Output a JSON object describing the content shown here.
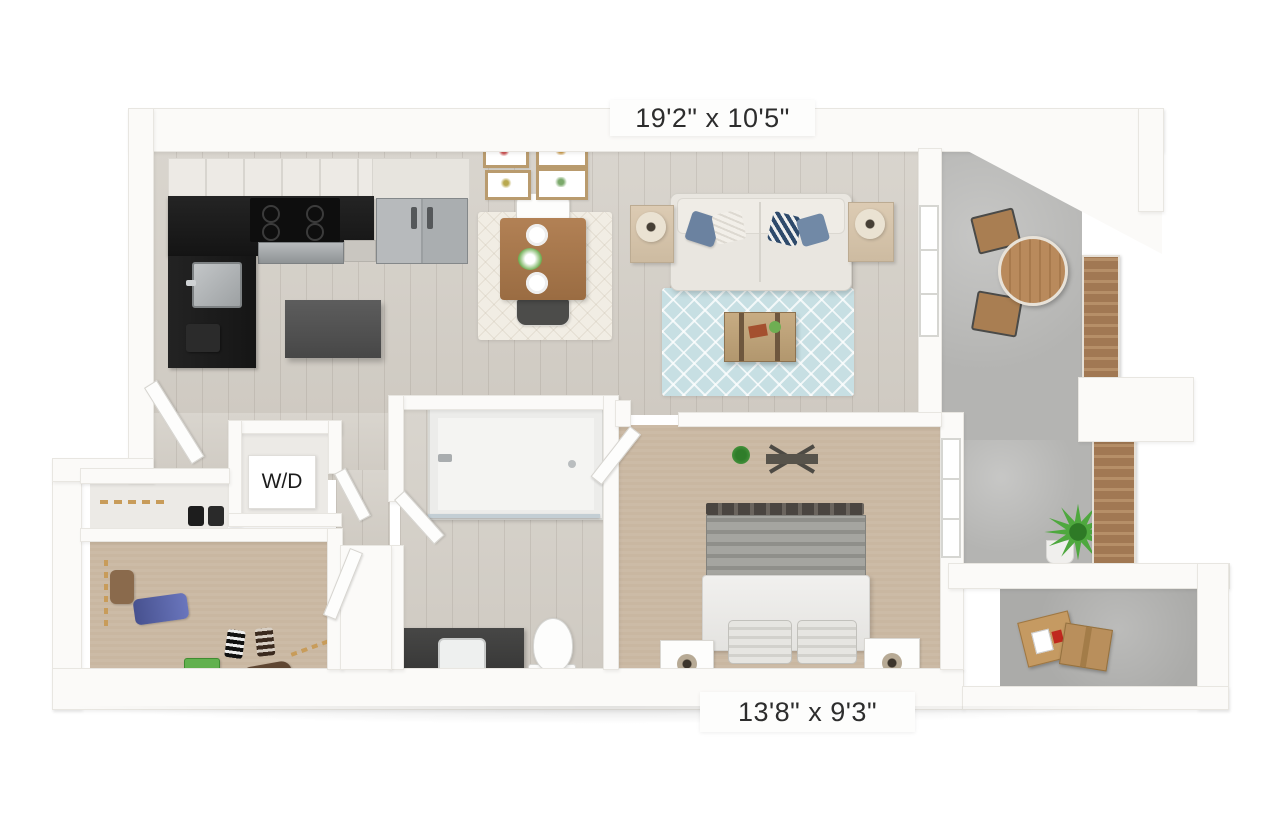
{
  "labels": {
    "living_room_dimensions": "19'2\" x 10'5\"",
    "bedroom_dimensions": "13'8\" x 9'3\"",
    "washer_dryer": "W/D"
  },
  "colors": {
    "background": "#ffffff",
    "wall": "#fbfaf8",
    "wood_floor": "#d5d1c9",
    "carpet_tan": "#c9b7a1",
    "concrete_gray": "#b4b4b2",
    "counter_black": "#191919",
    "island_gray": "#505050",
    "stainless_steel": "#a6a9ab",
    "sofa_cream": "#e9e6e0",
    "pillow_slate_blue": "#6b82a0",
    "pillow_navy": "#2e4a6b",
    "area_rug_blue": "#c7dfe3",
    "dining_rug_white": "#f1ede4",
    "table_wood": "#a87a4f",
    "trunk_wood": "#bda37c",
    "bed_blanket_gray": "#96968f",
    "duvet_white": "#eeedeb",
    "dresser_wood": "#d6c2a1",
    "railing_wood": "#a17853",
    "plant_green": "#4ea83e",
    "cardboard": "#c59a62",
    "label_text": "#2d2d2d"
  }
}
